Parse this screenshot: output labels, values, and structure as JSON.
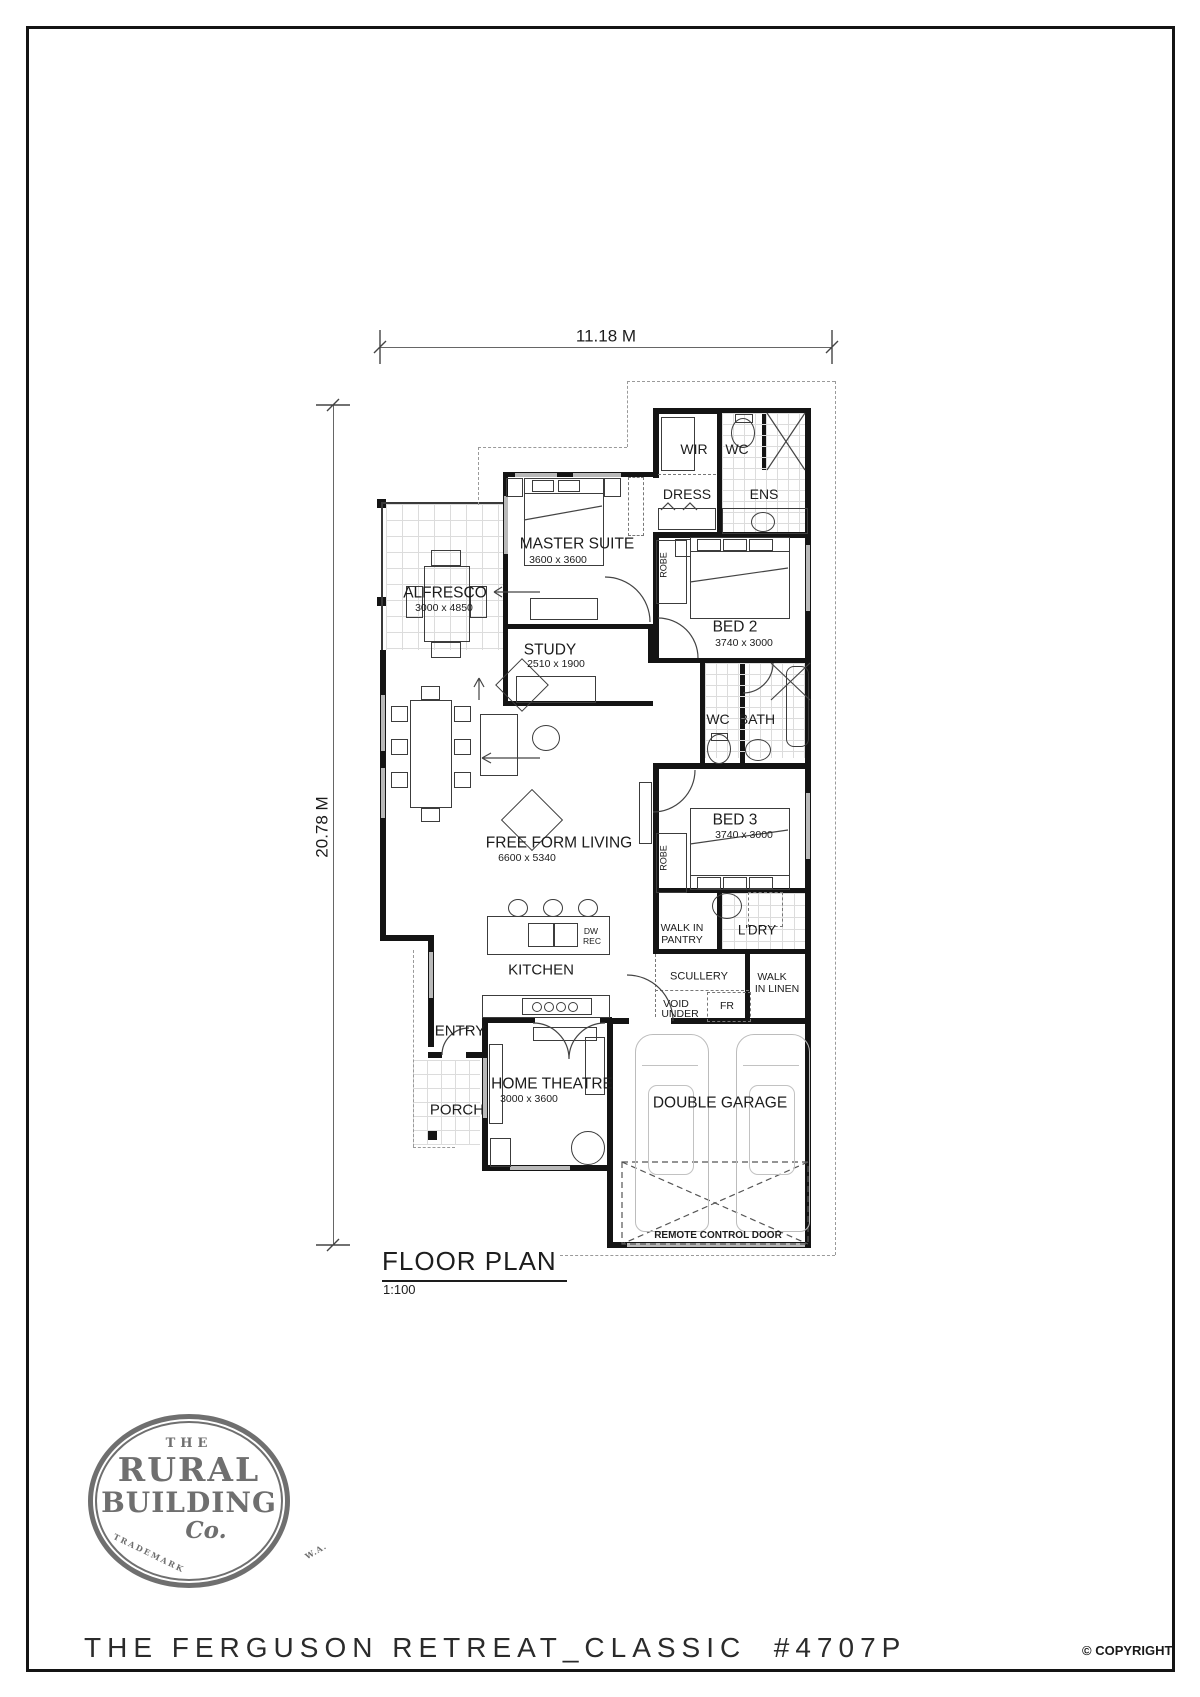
{
  "dimensions": {
    "width": "11.18 M",
    "height": "20.78 M"
  },
  "rooms": {
    "wir": "WIR",
    "wc1": "WC",
    "dress": "DRESS",
    "ens": "ENS",
    "master": {
      "name": "MASTER SUITE",
      "size": "3600 x 3600"
    },
    "robe1": "ROBE",
    "robe2": "ROBE",
    "bed2": {
      "name": "BED 2",
      "size": "3740 x 3000"
    },
    "study": {
      "name": "STUDY",
      "size": "2510 x 1900"
    },
    "alfresco": {
      "name": "ALFRESCO",
      "size": "3000 x 4850"
    },
    "wc2": "WC",
    "bath": "BATH",
    "bed3": {
      "name": "BED 3",
      "size": "3740 x 3000"
    },
    "living": {
      "name": "FREE FORM LIVING",
      "size": "6600 x 5340"
    },
    "kitchen": "KITCHEN",
    "island_note_l1": "DW",
    "island_note_l2": "REC",
    "pantry_l1": "WALK IN",
    "pantry_l2": "PANTRY",
    "ldry": "L'DRY",
    "scullery": "SCULLERY",
    "linen_l1": "WALK",
    "linen_l2": "IN LINEN",
    "void_l1": "VOID",
    "void_l2": "UNDER",
    "fridge": "FR",
    "entry": "ENTRY",
    "porch": "PORCH",
    "theatre": {
      "name": "HOME THEATRE",
      "size": "3000 x 3600"
    },
    "garage": "DOUBLE GARAGE",
    "remote_door": "REMOTE CONTROL DOOR"
  },
  "plan": {
    "title": "FLOOR PLAN",
    "scale": "1:100"
  },
  "logo": {
    "the": "THE",
    "rural": "RURAL",
    "building": "BUILDING",
    "co": "Co.",
    "trademark": "TRADEMARK",
    "wa": "W.A."
  },
  "footer": {
    "title": "THE FERGUSON RETREAT_CLASSIC  #4707P",
    "copyright": "© COPYRIGHT"
  }
}
